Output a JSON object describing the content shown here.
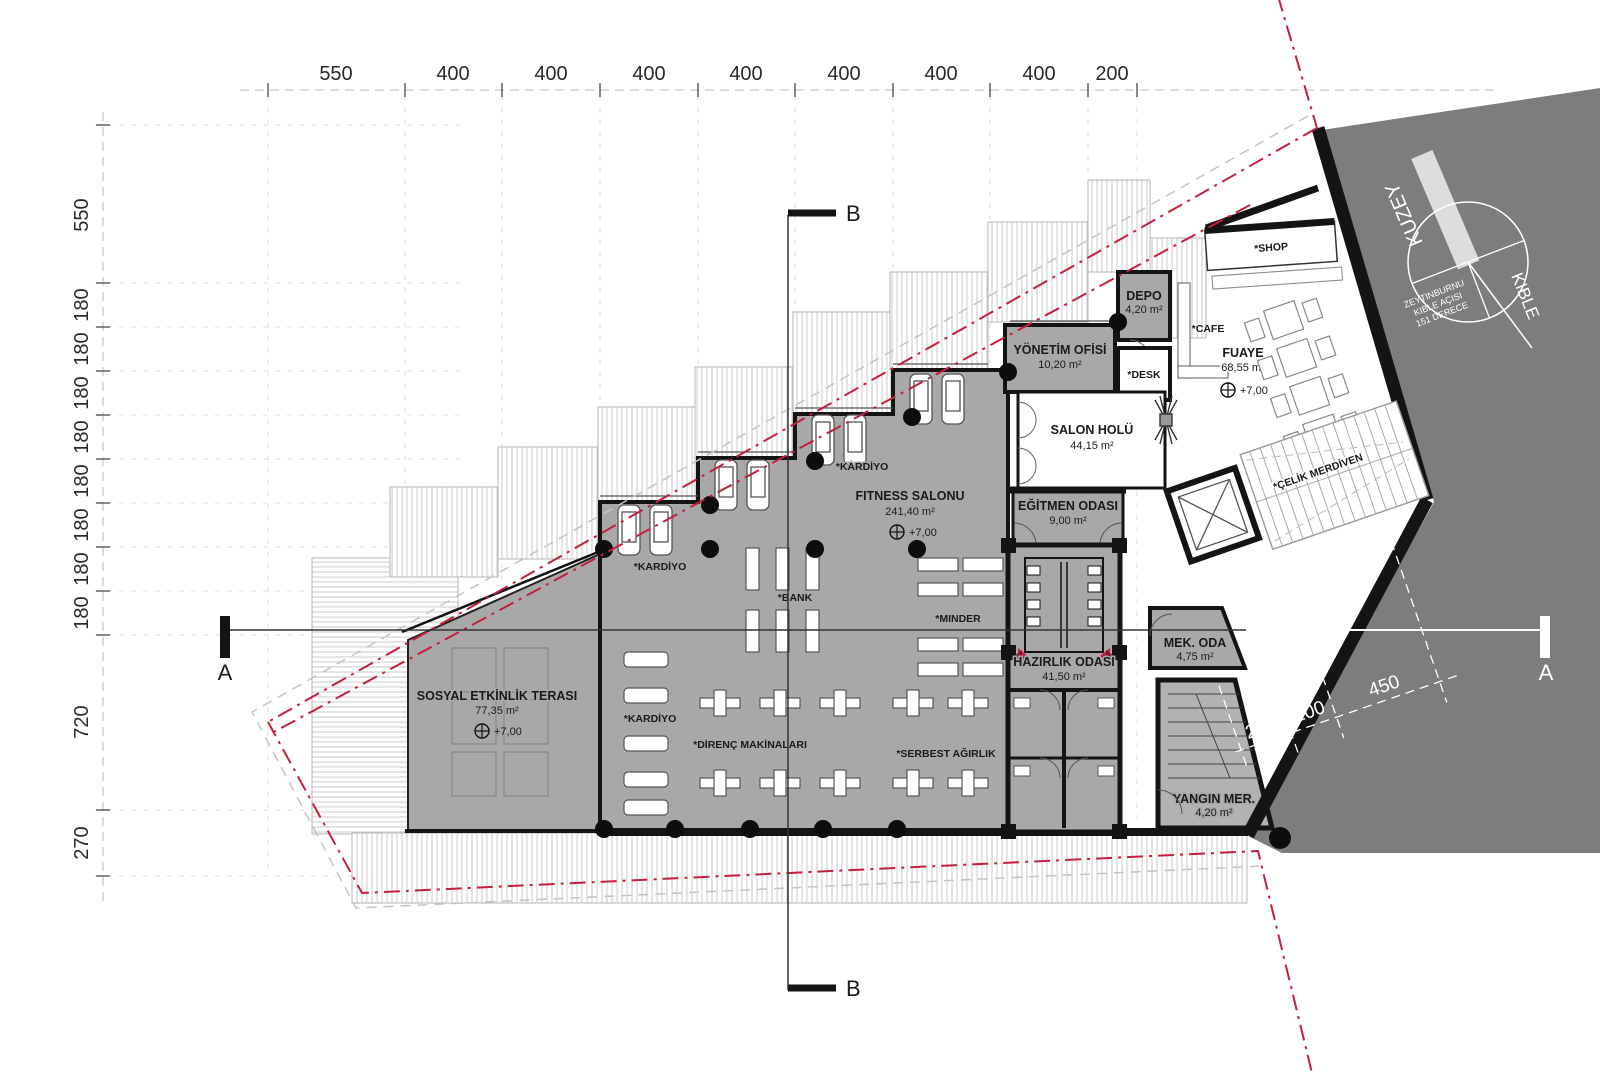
{
  "title": "Fitness center floor plan (+7,00 level)",
  "dims_top": [
    "550",
    "400",
    "400",
    "400",
    "400",
    "400",
    "400",
    "400",
    "200"
  ],
  "dims_left": [
    "550",
    "180",
    "180",
    "180",
    "180",
    "180",
    "180",
    "180",
    "180",
    "720",
    "270"
  ],
  "dims_site": [
    "220",
    "200",
    "450"
  ],
  "rooms": {
    "fitness_name": "FITNESS SALONU",
    "fitness_area": "241,40 m²",
    "teras_name": "SOSYAL ETKİNLİK TERASI",
    "teras_area": "77,35 m²",
    "hazirlik_name": "HAZIRLIK ODASI",
    "hazirlik_area": "41,50 m²",
    "salon_name": "SALON HOLÜ",
    "salon_area": "44,15 m²",
    "egitmen_name": "EĞİTMEN ODASI",
    "egitmen_area": "9,00 m²",
    "fuaye_name": "FUAYE",
    "fuaye_area": "68,55 m²",
    "yonetim_name": "YÖNETİM OFİSİ",
    "yonetim_area": "10,20 m²",
    "depo_name": "DEPO",
    "depo_area": "4,20 m²",
    "mek_name": "MEK. ODA",
    "mek_area": "4,75 m²",
    "yangin_name": "YANGIN MER.",
    "yangin_area": "4,20 m²",
    "level": "+7,00"
  },
  "zones": {
    "shop": "*SHOP",
    "cafe": "*CAFE",
    "desk": "*DESK",
    "kardiyo": "*KARDİYO",
    "bank": "*BANK",
    "minder": "*MINDER",
    "direnc": "*DİRENÇ MAKİNALARI",
    "serbest": "*SERBEST AĞIRLIK",
    "celik": "*ÇELİK MERDİVEN"
  },
  "compass": {
    "north": "KUZEY",
    "qibla": "KIBLE",
    "note1": "ZEYTINBURNU",
    "note2": "KIBLE AÇISI",
    "note3": "151 DERECE"
  },
  "sections": {
    "a": "A",
    "b": "B"
  },
  "colors": {
    "room_gray": "#a8a8a8",
    "site_dark": "#7d7d7d",
    "wall_black": "#141414",
    "boundary_red": "#c41f3e",
    "hatch": "#c9c9c9"
  }
}
